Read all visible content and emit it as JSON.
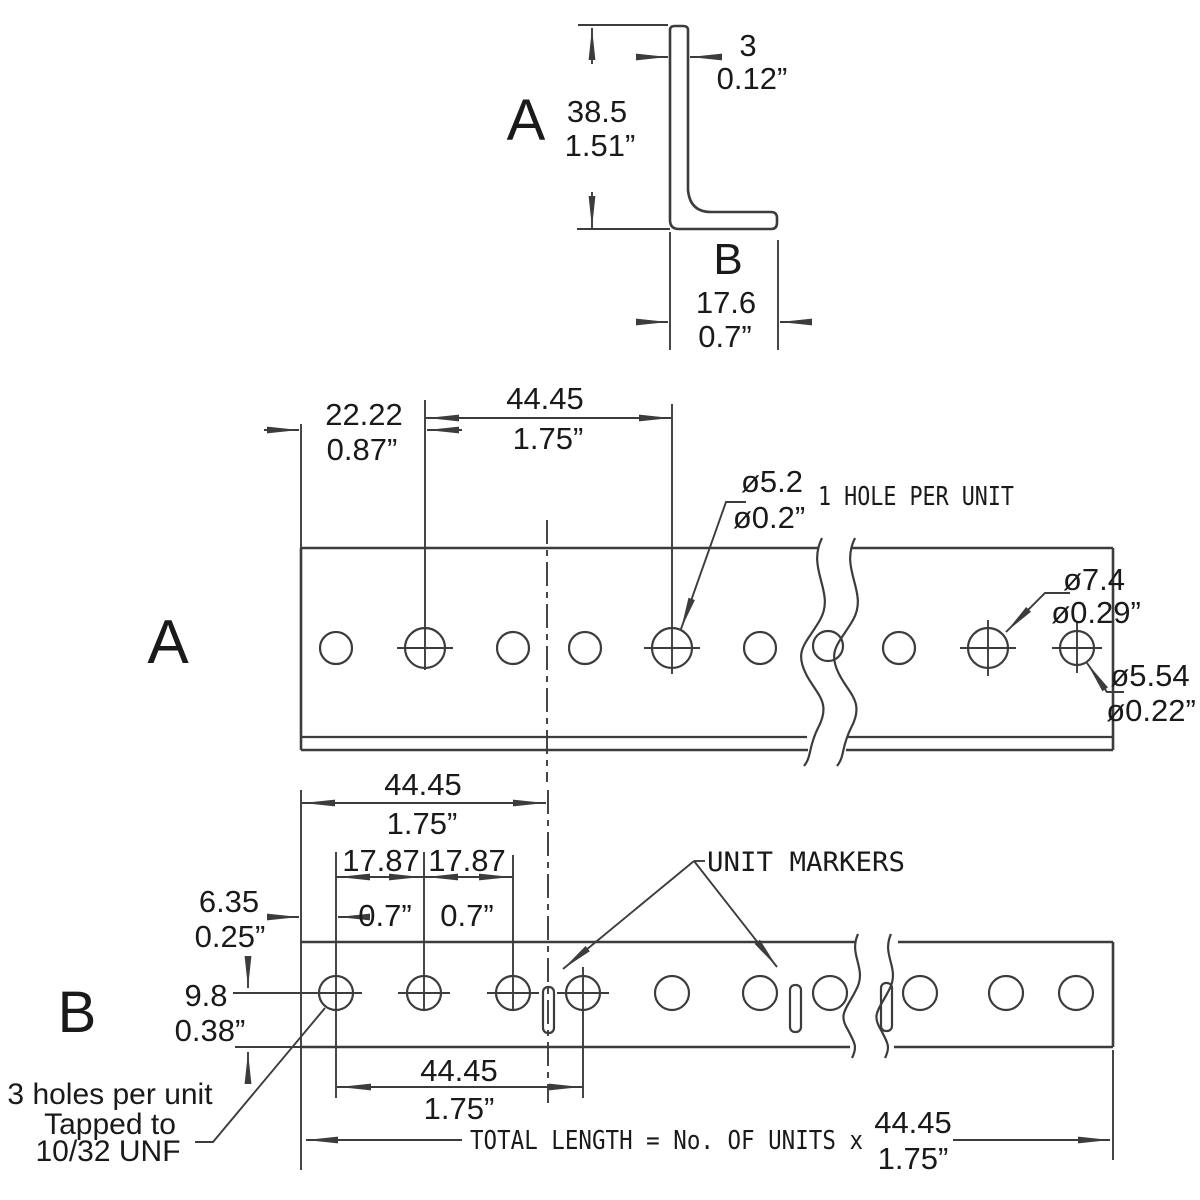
{
  "colors": {
    "background": "#ffffff",
    "line": "#3c3c3c",
    "text": "#1a1a1a"
  },
  "cross_section": {
    "label_a": "A",
    "label_b": "B",
    "height_mm": "38.5",
    "height_in": "1.51”",
    "thickness_mm": "3",
    "thickness_in": "0.12”",
    "width_mm": "17.6",
    "width_in": "0.7”"
  },
  "view_a": {
    "label": "A",
    "end_offset_mm": "22.22",
    "end_offset_in": "0.87”",
    "pitch_mm": "44.45",
    "pitch_in": "1.75”",
    "unit_hole_mm": "ø5.2",
    "unit_hole_in": "ø0.2”",
    "unit_hole_note": "1 HOLE PER UNIT",
    "big_hole_mm": "ø7.4",
    "big_hole_in": "ø0.29”",
    "small_hole_mm": "ø5.54",
    "small_hole_in": "ø0.22”"
  },
  "view_b": {
    "label": "B",
    "pitch_top_mm": "44.45",
    "pitch_top_in": "1.75”",
    "spacing_left_mm": "17.87",
    "spacing_left_in": "0.7”",
    "spacing_right_mm": "17.87",
    "spacing_right_in": "0.7”",
    "edge_offset_mm": "6.35",
    "edge_offset_in": "0.25”",
    "hole_offset_mm": "9.8",
    "hole_offset_in": "0.38”",
    "markers_label": "UNIT MARKERS",
    "tapped_line1": "3 holes per unit",
    "tapped_line2": "Tapped to",
    "tapped_line3": "10/32 UNF",
    "pitch_bottom_mm": "44.45",
    "pitch_bottom_in": "1.75”",
    "total_formula": "TOTAL LENGTH = No. OF UNITS x",
    "total_mm": "44.45",
    "total_in": "1.75”"
  }
}
